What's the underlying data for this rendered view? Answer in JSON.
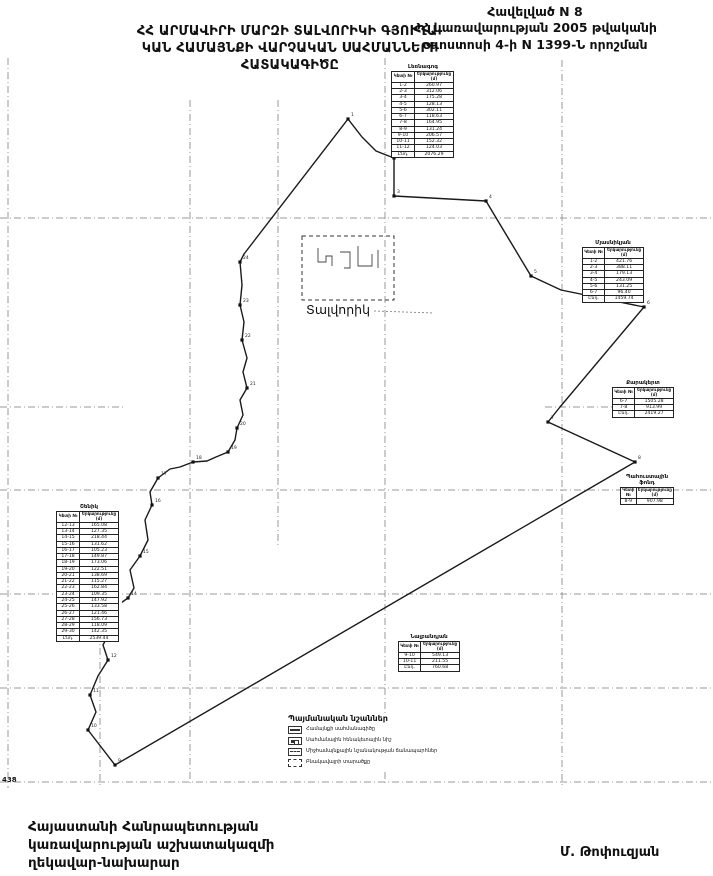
{
  "header": {
    "annex": [
      "Հավելված N 8",
      "ՀՀ կառավարության 2005 թվականի",
      "օգոստոսի 4-ի N 1399-Ն որոշման"
    ],
    "title": [
      "ՀՀ ԱՐՄԱՎԻՐԻ ՄԱՐԶԻ ՏԱԼՎՈՐԻԿԻ ԳՅՈՒՂԱ-",
      "ԿԱՆ ՀԱՄԱՅՆՔԻ ՎԱՐՉԱԿԱՆ ՍԱՀՄԱՆՆԵՐԻ",
      "ՀԱՏԱԿԱԳԻԾԸ"
    ]
  },
  "map": {
    "settlement_label": "Տալվորիկ",
    "settlement_rect": {
      "x": 302,
      "y": 236,
      "w": 92,
      "h": 64
    },
    "boundary": [
      [
        348,
        119
      ],
      [
        362,
        137
      ],
      [
        376,
        151
      ],
      [
        394,
        158
      ],
      [
        394,
        196
      ],
      [
        486,
        201
      ],
      [
        531,
        276
      ],
      [
        561,
        290
      ],
      [
        644,
        307
      ],
      [
        560,
        407
      ],
      [
        548,
        422
      ],
      [
        635,
        462
      ],
      [
        115,
        765
      ],
      [
        88,
        730
      ],
      [
        96,
        712
      ],
      [
        90,
        695
      ],
      [
        98,
        676
      ],
      [
        108,
        660
      ],
      [
        103,
        645
      ],
      [
        112,
        628
      ],
      [
        120,
        618
      ],
      [
        118,
        605
      ],
      [
        128,
        598
      ],
      [
        134,
        588
      ],
      [
        130,
        570
      ],
      [
        140,
        556
      ],
      [
        148,
        540
      ],
      [
        145,
        520
      ],
      [
        152,
        505
      ],
      [
        150,
        492
      ],
      [
        158,
        478
      ],
      [
        170,
        469
      ],
      [
        180,
        467
      ],
      [
        193,
        462
      ],
      [
        207,
        461
      ],
      [
        216,
        457
      ],
      [
        228,
        452
      ],
      [
        235,
        440
      ],
      [
        237,
        428
      ],
      [
        243,
        415
      ],
      [
        240,
        400
      ],
      [
        247,
        388
      ],
      [
        243,
        372
      ],
      [
        247,
        358
      ],
      [
        242,
        340
      ],
      [
        244,
        322
      ],
      [
        240,
        305
      ],
      [
        242,
        285
      ],
      [
        240,
        262
      ],
      [
        244,
        254
      ]
    ],
    "points": [
      {
        "x": 348,
        "y": 119,
        "label": "1"
      },
      {
        "x": 394,
        "y": 158,
        "label": "2"
      },
      {
        "x": 394,
        "y": 196,
        "label": "3"
      },
      {
        "x": 486,
        "y": 201,
        "label": "4"
      },
      {
        "x": 531,
        "y": 276,
        "label": "5"
      },
      {
        "x": 644,
        "y": 307,
        "label": "6"
      },
      {
        "x": 548,
        "y": 422,
        "label": "7"
      },
      {
        "x": 635,
        "y": 462,
        "label": "8"
      },
      {
        "x": 115,
        "y": 765,
        "label": "9"
      },
      {
        "x": 88,
        "y": 730,
        "label": "10"
      },
      {
        "x": 90,
        "y": 695,
        "label": "11"
      },
      {
        "x": 108,
        "y": 660,
        "label": "12"
      },
      {
        "x": 112,
        "y": 628,
        "label": "13"
      },
      {
        "x": 128,
        "y": 598,
        "label": "14"
      },
      {
        "x": 140,
        "y": 556,
        "label": "15"
      },
      {
        "x": 152,
        "y": 505,
        "label": "16"
      },
      {
        "x": 158,
        "y": 478,
        "label": "17"
      },
      {
        "x": 193,
        "y": 462,
        "label": "18"
      },
      {
        "x": 228,
        "y": 452,
        "label": "19"
      },
      {
        "x": 237,
        "y": 428,
        "label": "20"
      },
      {
        "x": 247,
        "y": 388,
        "label": "21"
      },
      {
        "x": 242,
        "y": 340,
        "label": "22"
      },
      {
        "x": 240,
        "y": 305,
        "label": "23"
      },
      {
        "x": 240,
        "y": 262,
        "label": "24"
      }
    ],
    "grid_h": [
      {
        "y": 218,
        "x1": 0,
        "x2": 713
      },
      {
        "y": 407,
        "x1": 0,
        "x2": 125
      },
      {
        "y": 407,
        "x1": 545,
        "x2": 665
      },
      {
        "y": 490,
        "x1": 0,
        "x2": 713
      },
      {
        "y": 594,
        "x1": 0,
        "x2": 713
      },
      {
        "y": 688,
        "x1": 0,
        "x2": 713
      },
      {
        "y": 782,
        "x1": 0,
        "x2": 713
      }
    ],
    "grid_v": [
      {
        "x": 8,
        "y1": 58,
        "y2": 788
      },
      {
        "x": 100,
        "y1": 592,
        "y2": 785
      },
      {
        "x": 190,
        "y1": 100,
        "y2": 785
      },
      {
        "x": 278,
        "y1": 100,
        "y2": 545
      },
      {
        "x": 385,
        "y1": 58,
        "y2": 785
      },
      {
        "x": 562,
        "y1": 60,
        "y2": 785
      }
    ]
  },
  "tables": {
    "north": {
      "title": "Լեռնագոգ",
      "col1": "Կետի №",
      "col2": "Երկարությունը (մ)",
      "rows": [
        [
          "1-2",
          "260.97"
        ],
        [
          "2-3",
          "312.06"
        ],
        [
          "3-4",
          "175.28"
        ],
        [
          "4-5",
          "128.13"
        ],
        [
          "5-6",
          "302.11"
        ],
        [
          "6-7",
          "118.63"
        ],
        [
          "7-8",
          "164.95"
        ],
        [
          "8-9",
          "131.24"
        ],
        [
          "9-10",
          "206.57"
        ],
        [
          "10-11",
          "152.32"
        ],
        [
          "11-12",
          "124.03"
        ],
        [
          "Ընդ.",
          "2076.29"
        ]
      ]
    },
    "east_upper": {
      "title": "Մյասնիկյան",
      "col1": "Կետի №",
      "col2": "Երկարությունը (մ)",
      "rows": [
        [
          "1-2",
          "421.76"
        ],
        [
          "2-3",
          "388.11"
        ],
        [
          "3-4",
          "179.13"
        ],
        [
          "4-5",
          "243.09"
        ],
        [
          "5-6",
          "131.25"
        ],
        [
          "6-7",
          "96.40"
        ],
        [
          "Ընդ.",
          "1459.74"
        ]
      ]
    },
    "east_mid": {
      "title": "Քարակերտ",
      "col1": "Կետի №",
      "col2": "Երկարությունը (մ)",
      "rows": [
        [
          "6-7",
          "1505.28"
        ],
        [
          "7-8",
          "913.99"
        ],
        [
          "Ընդ.",
          "2419.27"
        ]
      ]
    },
    "east_small": {
      "title": "Պահուստային ֆոնդ",
      "col1": "Կետի №",
      "col2": "Երկարությունը (մ)",
      "rows": [
        [
          "8-9",
          "907.98"
        ]
      ]
    },
    "west": {
      "title": "Շենիկ",
      "col1": "Կետի №",
      "col2": "Երկարությունը (մ)",
      "rows": [
        [
          "12-13",
          "165.08"
        ],
        [
          "13-14",
          "127.35"
        ],
        [
          "14-15",
          "218.44"
        ],
        [
          "15-16",
          "131.62"
        ],
        [
          "16-17",
          "105.23"
        ],
        [
          "17-18",
          "149.87"
        ],
        [
          "18-19",
          "173.06"
        ],
        [
          "19-20",
          "122.51"
        ],
        [
          "20-21",
          "138.69"
        ],
        [
          "21-22",
          "115.27"
        ],
        [
          "22-23",
          "162.84"
        ],
        [
          "23-24",
          "109.35"
        ],
        [
          "24-25",
          "147.92"
        ],
        [
          "25-26",
          "133.58"
        ],
        [
          "26-27",
          "121.46"
        ],
        [
          "27-28",
          "156.73"
        ],
        [
          "28-29",
          "118.09"
        ],
        [
          "29-30",
          "142.35"
        ],
        [
          "Ընդ.",
          "2539.44"
        ]
      ]
    },
    "south": {
      "title": "Նալբանդյան",
      "col1": "Կետի №",
      "col2": "Երկարությունը (մ)",
      "rows": [
        [
          "9-10",
          "549.13"
        ],
        [
          "10-11",
          "211.55"
        ],
        [
          "Ընդ.",
          "760.68"
        ]
      ]
    }
  },
  "legend": {
    "title": "Պայմանական նշաններ",
    "items": [
      {
        "icon": "community-boundary-icon",
        "label": "Համայնքի սահմանագիծը"
      },
      {
        "icon": "benchmark-icon",
        "label": "Սահմանային հենակետային նիշ"
      },
      {
        "icon": "road-icon",
        "label": "Միջհամայնքային նշանակության ճանապարհներ"
      },
      {
        "icon": "settlement-area-icon",
        "label": "Բնակավայրի տարածքը"
      }
    ]
  },
  "footer": {
    "lines": [
      "Հայաստանի Հանրապետության",
      "կառավարության աշխատակազմի",
      "ղեկավար-նախարար"
    ],
    "signature": "Մ. Թոփուզյան",
    "page_number": "438"
  }
}
